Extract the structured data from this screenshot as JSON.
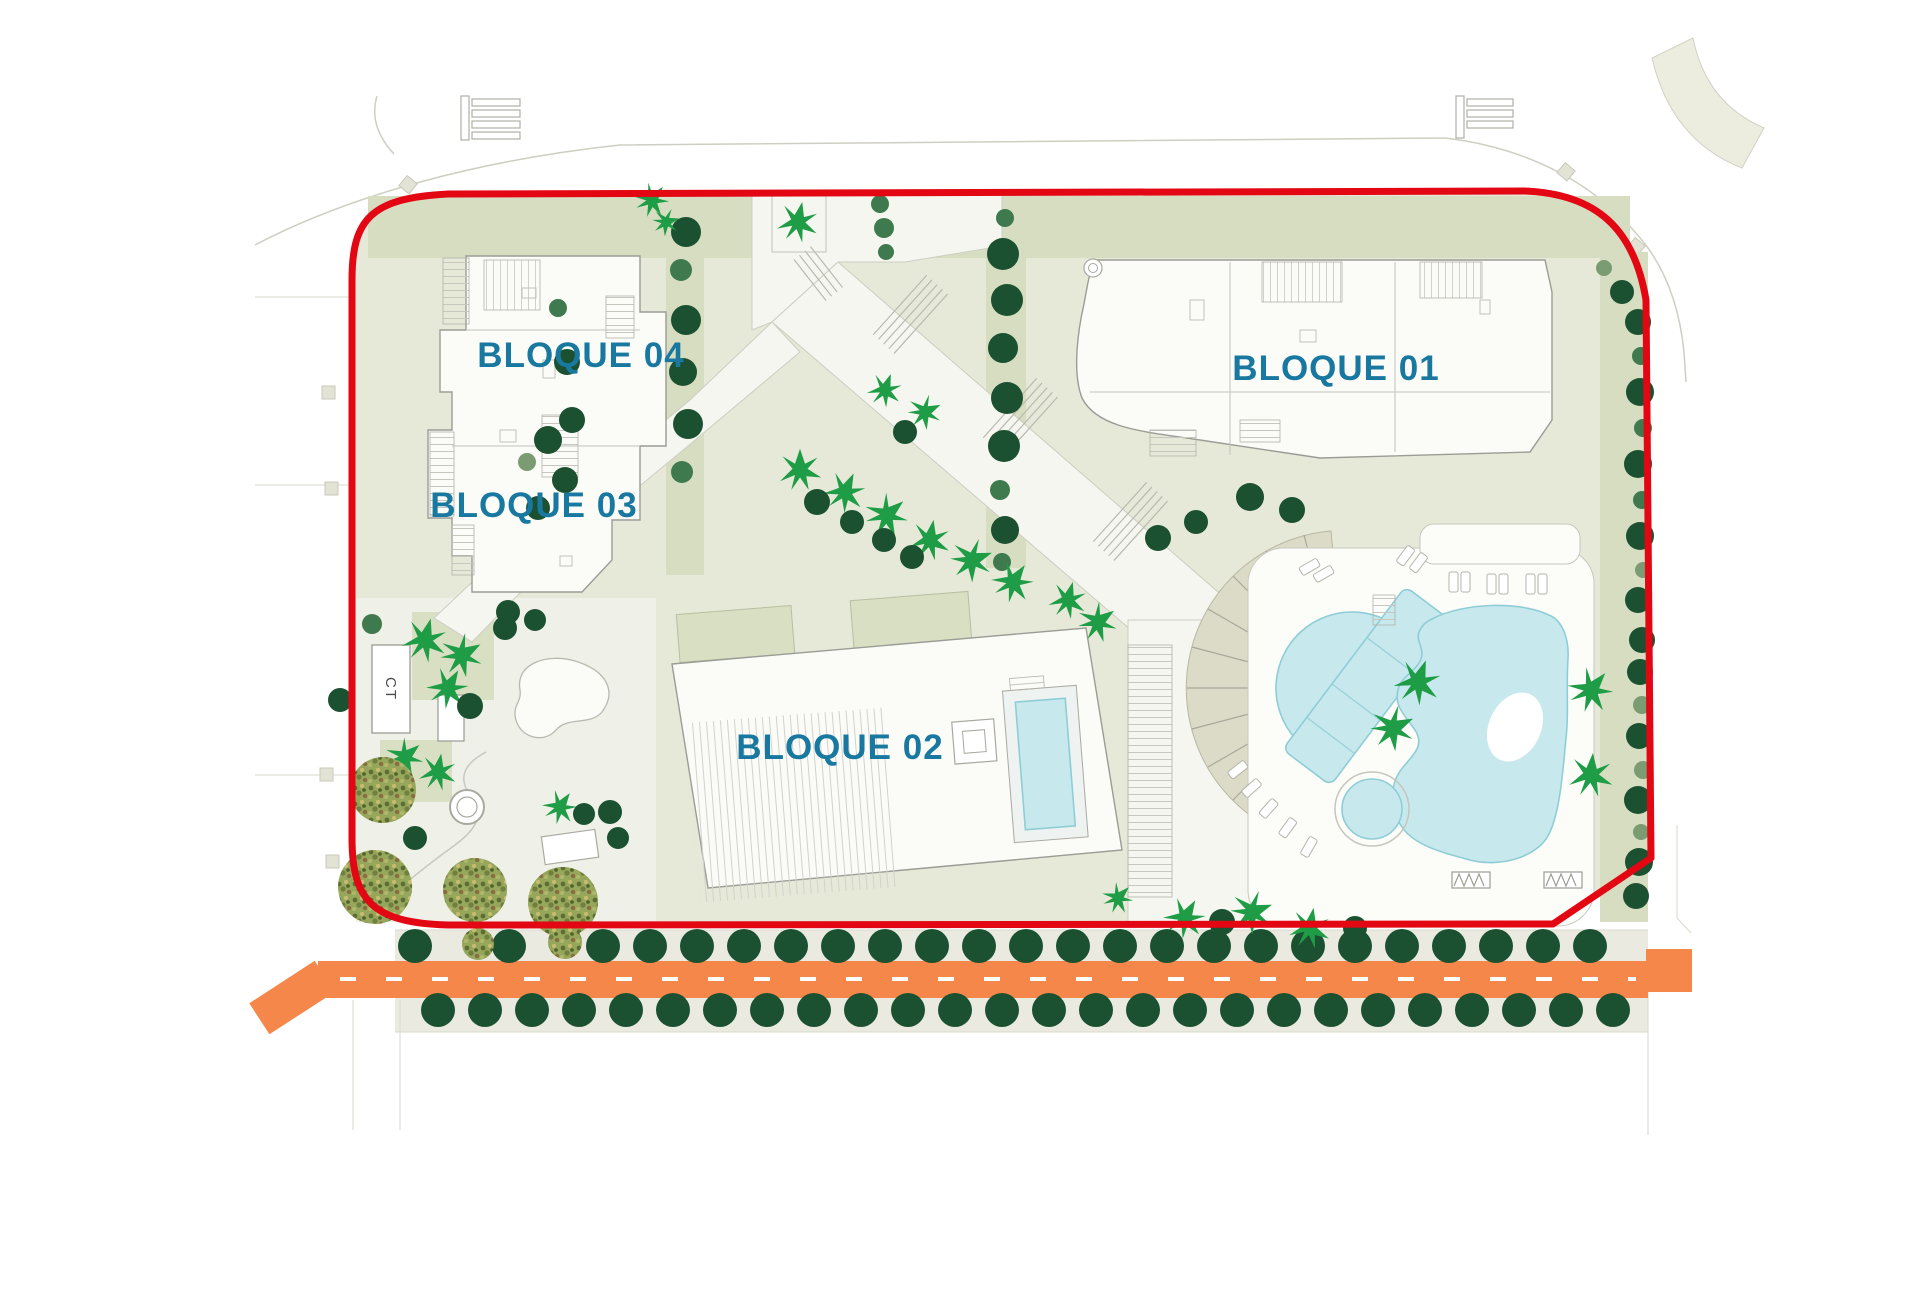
{
  "labels": {
    "bloque01": "BLOQUE 01",
    "bloque02": "BLOQUE 02",
    "bloque03": "BLOQUE 03",
    "bloque04": "BLOQUE 04",
    "ct": "CT"
  },
  "colors": {
    "boundary_red": "#e30613",
    "label_teal": "#1878a0",
    "road_orange": "#f6874a",
    "pool_blue": "#c7e9ee",
    "pool_edge": "#8fcdd6",
    "tree_dark": "#1b5130",
    "tree_mid": "#3f7a4e",
    "tree_light": "#7b9b72",
    "palm_green": "#1e9c46",
    "site_sage": "#e6e9d8",
    "lawn_sage": "#d7ddc1",
    "strip_gray": "#eaeae1"
  }
}
